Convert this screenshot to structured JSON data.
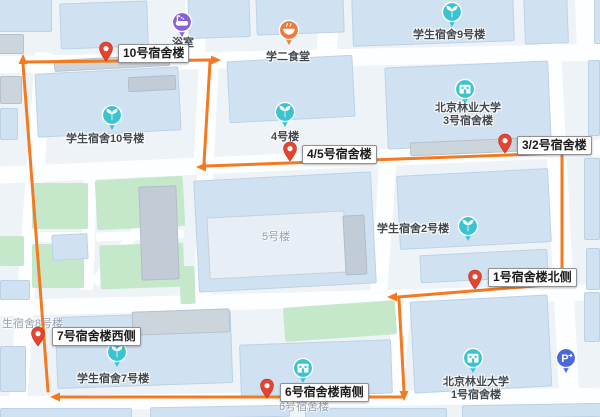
{
  "map": {
    "colors": {
      "background": "#eef3f7",
      "road": "#fdfeff",
      "block_blue": "#d0e2f2",
      "block_pale": "#e7eef5",
      "block_gray": "#ccd4dc",
      "block_darkgray": "#c2ccd6",
      "green": "#c5e8cb",
      "route_orange": "#f4791f",
      "pin_red": "#e8432e",
      "pin_red_dark": "#b83223",
      "poi_teal": "#3ac3d1",
      "poi_purple": "#8a62d8",
      "poi_orange": "#f0793c",
      "poi_blue": "#4a68dd",
      "label_gray": "#41484f",
      "ghost_gray": "#96a2af"
    },
    "roads": [
      {
        "x": -6,
        "y": 50,
        "w": 612,
        "h": 17,
        "r": -1.2
      },
      {
        "x": -6,
        "y": 153,
        "w": 612,
        "h": 17,
        "r": -2.6
      },
      {
        "x": -6,
        "y": 296,
        "w": 330,
        "h": 16,
        "r": -1.5
      },
      {
        "x": 300,
        "y": 288,
        "w": 310,
        "h": 16,
        "r": -1.5
      },
      {
        "x": -6,
        "y": 392,
        "w": 612,
        "h": 15,
        "r": -0.8
      },
      {
        "x": 22,
        "y": 52,
        "w": 18,
        "h": 352,
        "r": 4.3
      },
      {
        "x": 184,
        "y": -6,
        "w": 22,
        "h": 70,
        "r": 3
      },
      {
        "x": 196,
        "y": 64,
        "w": 20,
        "h": 110,
        "r": 3
      },
      {
        "x": 196,
        "y": 172,
        "w": 16,
        "h": 128,
        "r": 1
      },
      {
        "x": 374,
        "y": 160,
        "w": 17,
        "h": 156,
        "r": 4
      },
      {
        "x": 389,
        "y": 298,
        "w": 18,
        "h": 102,
        "r": 5
      },
      {
        "x": 549,
        "y": -8,
        "w": 20,
        "h": 420,
        "r": -3
      },
      {
        "x": 576,
        "y": -6,
        "w": 24,
        "h": 60,
        "r": -2
      },
      {
        "x": 318,
        "y": -6,
        "w": 20,
        "h": 60,
        "r": 2
      },
      {
        "x": 82,
        "y": 176,
        "w": 13,
        "h": 114,
        "r": 2
      },
      {
        "x": 30,
        "y": 232,
        "w": 62,
        "h": 10,
        "r": 0
      },
      {
        "x": 96,
        "y": 231,
        "w": 88,
        "h": 9,
        "r": -2
      },
      {
        "x": 131,
        "y": 166,
        "w": 10,
        "h": 132,
        "r": 39
      }
    ],
    "greens": [
      {
        "x": 32,
        "y": 183,
        "w": 56,
        "h": 46
      },
      {
        "x": 96,
        "y": 178,
        "w": 88,
        "h": 50,
        "r": -3
      },
      {
        "x": 32,
        "y": 244,
        "w": 52,
        "h": 44
      },
      {
        "x": 100,
        "y": 244,
        "w": 84,
        "h": 44,
        "r": -2
      },
      {
        "x": 284,
        "y": 304,
        "w": 112,
        "h": 34,
        "r": -4
      },
      {
        "x": 0,
        "y": 236,
        "w": 24,
        "h": 30
      },
      {
        "x": 180,
        "y": 266,
        "w": 15,
        "h": 38,
        "r": -2
      }
    ],
    "buildings": [
      {
        "x": -8,
        "y": -6,
        "w": 60,
        "h": 38,
        "c": "b"
      },
      {
        "x": -8,
        "y": 34,
        "w": 32,
        "h": 20,
        "c": "g"
      },
      {
        "x": 60,
        "y": 2,
        "w": 88,
        "h": 46,
        "c": "b",
        "r": -2
      },
      {
        "x": 188,
        "y": -8,
        "w": 62,
        "h": 46,
        "c": "b",
        "r": -2
      },
      {
        "x": 256,
        "y": -8,
        "w": 88,
        "h": 42,
        "c": "b",
        "r": -2
      },
      {
        "x": 352,
        "y": -8,
        "w": 162,
        "h": 52,
        "c": "b",
        "r": -2
      },
      {
        "x": 524,
        "y": -8,
        "w": 44,
        "h": 52,
        "c": "b",
        "r": -2
      },
      {
        "x": 594,
        "y": -6,
        "w": 14,
        "h": 50,
        "c": "b"
      },
      {
        "x": 0,
        "y": 76,
        "w": 22,
        "h": 28,
        "c": "g"
      },
      {
        "x": 0,
        "y": 108,
        "w": 18,
        "h": 32,
        "c": "b"
      },
      {
        "x": 36,
        "y": 70,
        "w": 144,
        "h": 64,
        "c": "b",
        "r": -3
      },
      {
        "x": 54,
        "y": 57,
        "w": 116,
        "h": 12,
        "c": "g",
        "r": -3
      },
      {
        "x": 128,
        "y": 76,
        "w": 48,
        "h": 15,
        "c": "dg",
        "r": -3
      },
      {
        "x": 228,
        "y": 58,
        "w": 126,
        "h": 62,
        "c": "b",
        "r": -3
      },
      {
        "x": 386,
        "y": 64,
        "w": 164,
        "h": 82,
        "c": "b",
        "r": -2.5
      },
      {
        "x": 410,
        "y": 140,
        "w": 110,
        "h": 14,
        "c": "g",
        "r": -2.5
      },
      {
        "x": 588,
        "y": 60,
        "w": 12,
        "h": 76,
        "c": "b"
      },
      {
        "x": 140,
        "y": 186,
        "w": 38,
        "h": 94,
        "c": "dg",
        "r": -2
      },
      {
        "x": 196,
        "y": 176,
        "w": 178,
        "h": 112,
        "c": "b",
        "r": -3
      },
      {
        "x": 208,
        "y": 214,
        "w": 138,
        "h": 62,
        "c": "pale",
        "r": -3
      },
      {
        "x": 344,
        "y": 215,
        "w": 22,
        "h": 60,
        "c": "dg",
        "r": -3
      },
      {
        "x": 398,
        "y": 172,
        "w": 152,
        "h": 74,
        "c": "b",
        "r": -3
      },
      {
        "x": 420,
        "y": 252,
        "w": 128,
        "h": 28,
        "c": "b",
        "r": -3
      },
      {
        "x": 584,
        "y": 158,
        "w": 16,
        "h": 82,
        "c": "b"
      },
      {
        "x": 586,
        "y": 248,
        "w": 14,
        "h": 42,
        "c": "b"
      },
      {
        "x": 52,
        "y": 234,
        "w": 36,
        "h": 26,
        "c": "b",
        "r": -3
      },
      {
        "x": 0,
        "y": 280,
        "w": 30,
        "h": 20,
        "c": "b"
      },
      {
        "x": 0,
        "y": 346,
        "w": 26,
        "h": 46,
        "c": "b"
      },
      {
        "x": 56,
        "y": 314,
        "w": 176,
        "h": 72,
        "c": "b",
        "r": -2
      },
      {
        "x": 132,
        "y": 310,
        "w": 98,
        "h": 24,
        "c": "g",
        "r": -2
      },
      {
        "x": 240,
        "y": 342,
        "w": 152,
        "h": 54,
        "c": "b",
        "r": -2
      },
      {
        "x": 412,
        "y": 298,
        "w": 138,
        "h": 92,
        "c": "b",
        "r": -3
      },
      {
        "x": 584,
        "y": 292,
        "w": 16,
        "h": 50,
        "c": "b"
      },
      {
        "x": 0,
        "y": 408,
        "w": 132,
        "h": 10,
        "c": "b"
      },
      {
        "x": 150,
        "y": 406,
        "w": 140,
        "h": 12,
        "c": "b",
        "r": -1
      },
      {
        "x": 305,
        "y": 408,
        "w": 142,
        "h": 10,
        "c": "b"
      },
      {
        "x": 462,
        "y": 404,
        "w": 146,
        "h": 14,
        "c": "b",
        "r": -1
      }
    ],
    "route": {
      "stroke_width": 3,
      "segments": [
        [
          [
            48,
            391
          ],
          [
            23,
            64
          ]
        ],
        [
          [
            23,
            62
          ],
          [
            211,
            60
          ]
        ],
        [
          [
            210,
            62
          ],
          [
            204,
            163
          ]
        ],
        [
          [
            563,
            153
          ],
          [
            206,
            166
          ]
        ],
        [
          [
            562,
            155
          ],
          [
            562,
            267
          ]
        ],
        [
          [
            559,
            284
          ],
          [
            398,
            297
          ]
        ],
        [
          [
            399,
            299
          ],
          [
            404,
            391
          ]
        ],
        [
          [
            402,
            397
          ],
          [
            60,
            397
          ]
        ]
      ],
      "arrows": [
        {
          "x": 23,
          "y": 60,
          "d": "up"
        },
        {
          "x": 215,
          "y": 60,
          "d": "right"
        },
        {
          "x": 202,
          "y": 167,
          "d": "left"
        },
        {
          "x": 562,
          "y": 272,
          "d": "down"
        },
        {
          "x": 393,
          "y": 297,
          "d": "left"
        },
        {
          "x": 404,
          "y": 395,
          "d": "down"
        },
        {
          "x": 56,
          "y": 397,
          "d": "left"
        }
      ]
    },
    "pins": [
      {
        "x": 106,
        "y": 49,
        "label": "10号宿舍楼",
        "lx": 118,
        "ly": 44
      },
      {
        "x": 290,
        "y": 149,
        "label": "4/5号宿舍楼",
        "lx": 302,
        "ly": 145
      },
      {
        "x": 505,
        "y": 141,
        "label": "3/2号宿舍楼",
        "lx": 517,
        "ly": 136
      },
      {
        "x": 475,
        "y": 277,
        "label": "1号宿舍楼北侧",
        "lx": 488,
        "ly": 268
      },
      {
        "x": 38,
        "y": 334,
        "label": "7号宿舍楼西侧",
        "lx": 52,
        "ly": 327
      },
      {
        "x": 267,
        "y": 386,
        "label": "6号宿舍楼南侧",
        "lx": 280,
        "ly": 383
      }
    ],
    "pois": [
      {
        "x": 182,
        "y": 22,
        "t": "bath",
        "label": "浴室",
        "lx": 172,
        "ly": 34
      },
      {
        "x": 289,
        "y": 30,
        "t": "food",
        "label": "学二食堂",
        "lx": 266,
        "ly": 48
      },
      {
        "x": 452,
        "y": 12,
        "t": "sprout",
        "label": "学生宿舍9号楼",
        "lx": 413,
        "ly": 26
      },
      {
        "x": 465,
        "y": 89,
        "t": "building",
        "l1": "北京林业大学",
        "l2": "3号宿舍楼",
        "cx": 468,
        "ly": 102
      },
      {
        "x": 285,
        "y": 112,
        "t": "sprout",
        "label": "4号楼",
        "lx": 271,
        "ly": 128
      },
      {
        "x": 112,
        "y": 115,
        "t": "sprout",
        "label": "学生宿舍10号楼",
        "lx": 66,
        "ly": 130
      },
      {
        "x": 468,
        "y": 226,
        "t": "sprout",
        "label": "学生宿舍2号楼",
        "lx": 377,
        "ly": 220
      },
      {
        "x": 117,
        "y": 352,
        "t": "sprout",
        "label": "学生宿舍7号楼",
        "lx": 77,
        "ly": 370
      },
      {
        "x": 303,
        "y": 368,
        "t": "building"
      },
      {
        "x": 473,
        "y": 358,
        "t": "building",
        "l1": "北京林业大学",
        "l2": "1号宿舍楼",
        "cx": 476,
        "ly": 376
      },
      {
        "x": 566,
        "y": 358,
        "t": "parking"
      }
    ],
    "ghost_labels": [
      {
        "text": "5号楼",
        "x": 262,
        "y": 228
      },
      {
        "text": "6号宿舍楼",
        "x": 279,
        "y": 398
      },
      {
        "text": "生宿舍8号楼",
        "x": 2,
        "y": 315
      }
    ]
  }
}
